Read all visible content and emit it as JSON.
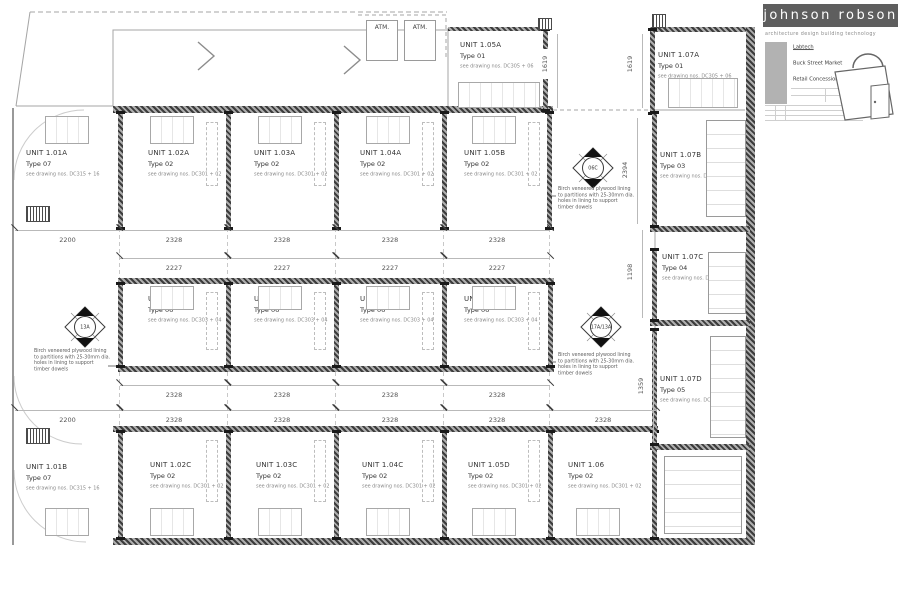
{
  "title_block": {
    "firm": "johnson robson",
    "tagline": "architecture   design   building technology",
    "client": "Labtech",
    "project": "Buck Street Market",
    "drawing_title": "Retail Concessions GA Plan"
  },
  "plan": {
    "atm_label": "ATM.",
    "plywood_note": "Birch veneered plywood lining to partitions with 25-30mm dia. holes in lining to support timber dowels",
    "markers": {
      "m1": "06C",
      "m2": "13A",
      "m3": "17A/13A"
    },
    "units": [
      {
        "name": "UNIT 1.01A",
        "type": "Type 07",
        "note": "see drawing nos. DC315 + 16"
      },
      {
        "name": "UNIT 1.02A",
        "type": "Type 02",
        "note": "see drawing nos. DC301 + 02"
      },
      {
        "name": "UNIT 1.03A",
        "type": "Type 02",
        "note": "see drawing nos. DC301 + 02"
      },
      {
        "name": "UNIT 1.04A",
        "type": "Type 02",
        "note": "see drawing nos. DC301 + 02"
      },
      {
        "name": "UNIT 1.05B",
        "type": "Type 02",
        "note": "see drawing nos. DC301 + 02"
      },
      {
        "name": "UNIT 1.05A",
        "type": "Type 01",
        "note": "see drawing nos. DC305 + 06"
      },
      {
        "name": "UNIT 1.07A",
        "type": "Type 01",
        "note": "see drawing nos. DC305 + 06"
      },
      {
        "name": "UNIT 1.07B",
        "type": "Type 03",
        "note": "see drawing nos. DC311 + 12"
      },
      {
        "name": "UNIT 1.07C",
        "type": "Type 04",
        "note": "see drawing nos. DC313 + 14"
      },
      {
        "name": "UNIT 1.07D",
        "type": "Type 05",
        "note": "see drawing nos. DC307-10"
      },
      {
        "name": "UNIT 1.02B",
        "type": "Type 06",
        "note": "see drawing nos. DC303 + 04"
      },
      {
        "name": "UNIT 1.03B",
        "type": "Type 06",
        "note": "see drawing nos. DC303 + 04"
      },
      {
        "name": "UNIT 1.04B",
        "type": "Type 06",
        "note": "see drawing nos. DC303 + 04"
      },
      {
        "name": "UNIT 1.05C",
        "type": "Type 06",
        "note": "see drawing nos. DC303 + 04"
      },
      {
        "name": "UNIT 1.01B",
        "type": "Type 07",
        "note": "see drawing nos. DC315 + 16"
      },
      {
        "name": "UNIT 1.02C",
        "type": "Type 02",
        "note": "see drawing nos. DC301 + 02"
      },
      {
        "name": "UNIT 1.03C",
        "type": "Type 02",
        "note": "see drawing nos. DC301 + 02"
      },
      {
        "name": "UNIT 1.04C",
        "type": "Type 02",
        "note": "see drawing nos. DC301 + 02"
      },
      {
        "name": "UNIT 1.05D",
        "type": "Type 02",
        "note": "see drawing nos. DC301 + 02"
      },
      {
        "name": "UNIT 1.06",
        "type": "Type 02",
        "note": "see drawing nos. DC301 + 02"
      }
    ],
    "dims": {
      "row1": [
        "2200",
        "2328",
        "2328",
        "2328",
        "2328"
      ],
      "row2": [
        "2227",
        "2227",
        "2227",
        "2227"
      ],
      "row3": [
        "2328",
        "2328",
        "2328",
        "2328"
      ],
      "row4": [
        "2200",
        "2328",
        "2328",
        "2328",
        "2328",
        "2328"
      ],
      "v1619a": "1619",
      "v1619b": "1619",
      "v2394": "2394",
      "v1198": "1198",
      "v1359": "1359"
    }
  }
}
